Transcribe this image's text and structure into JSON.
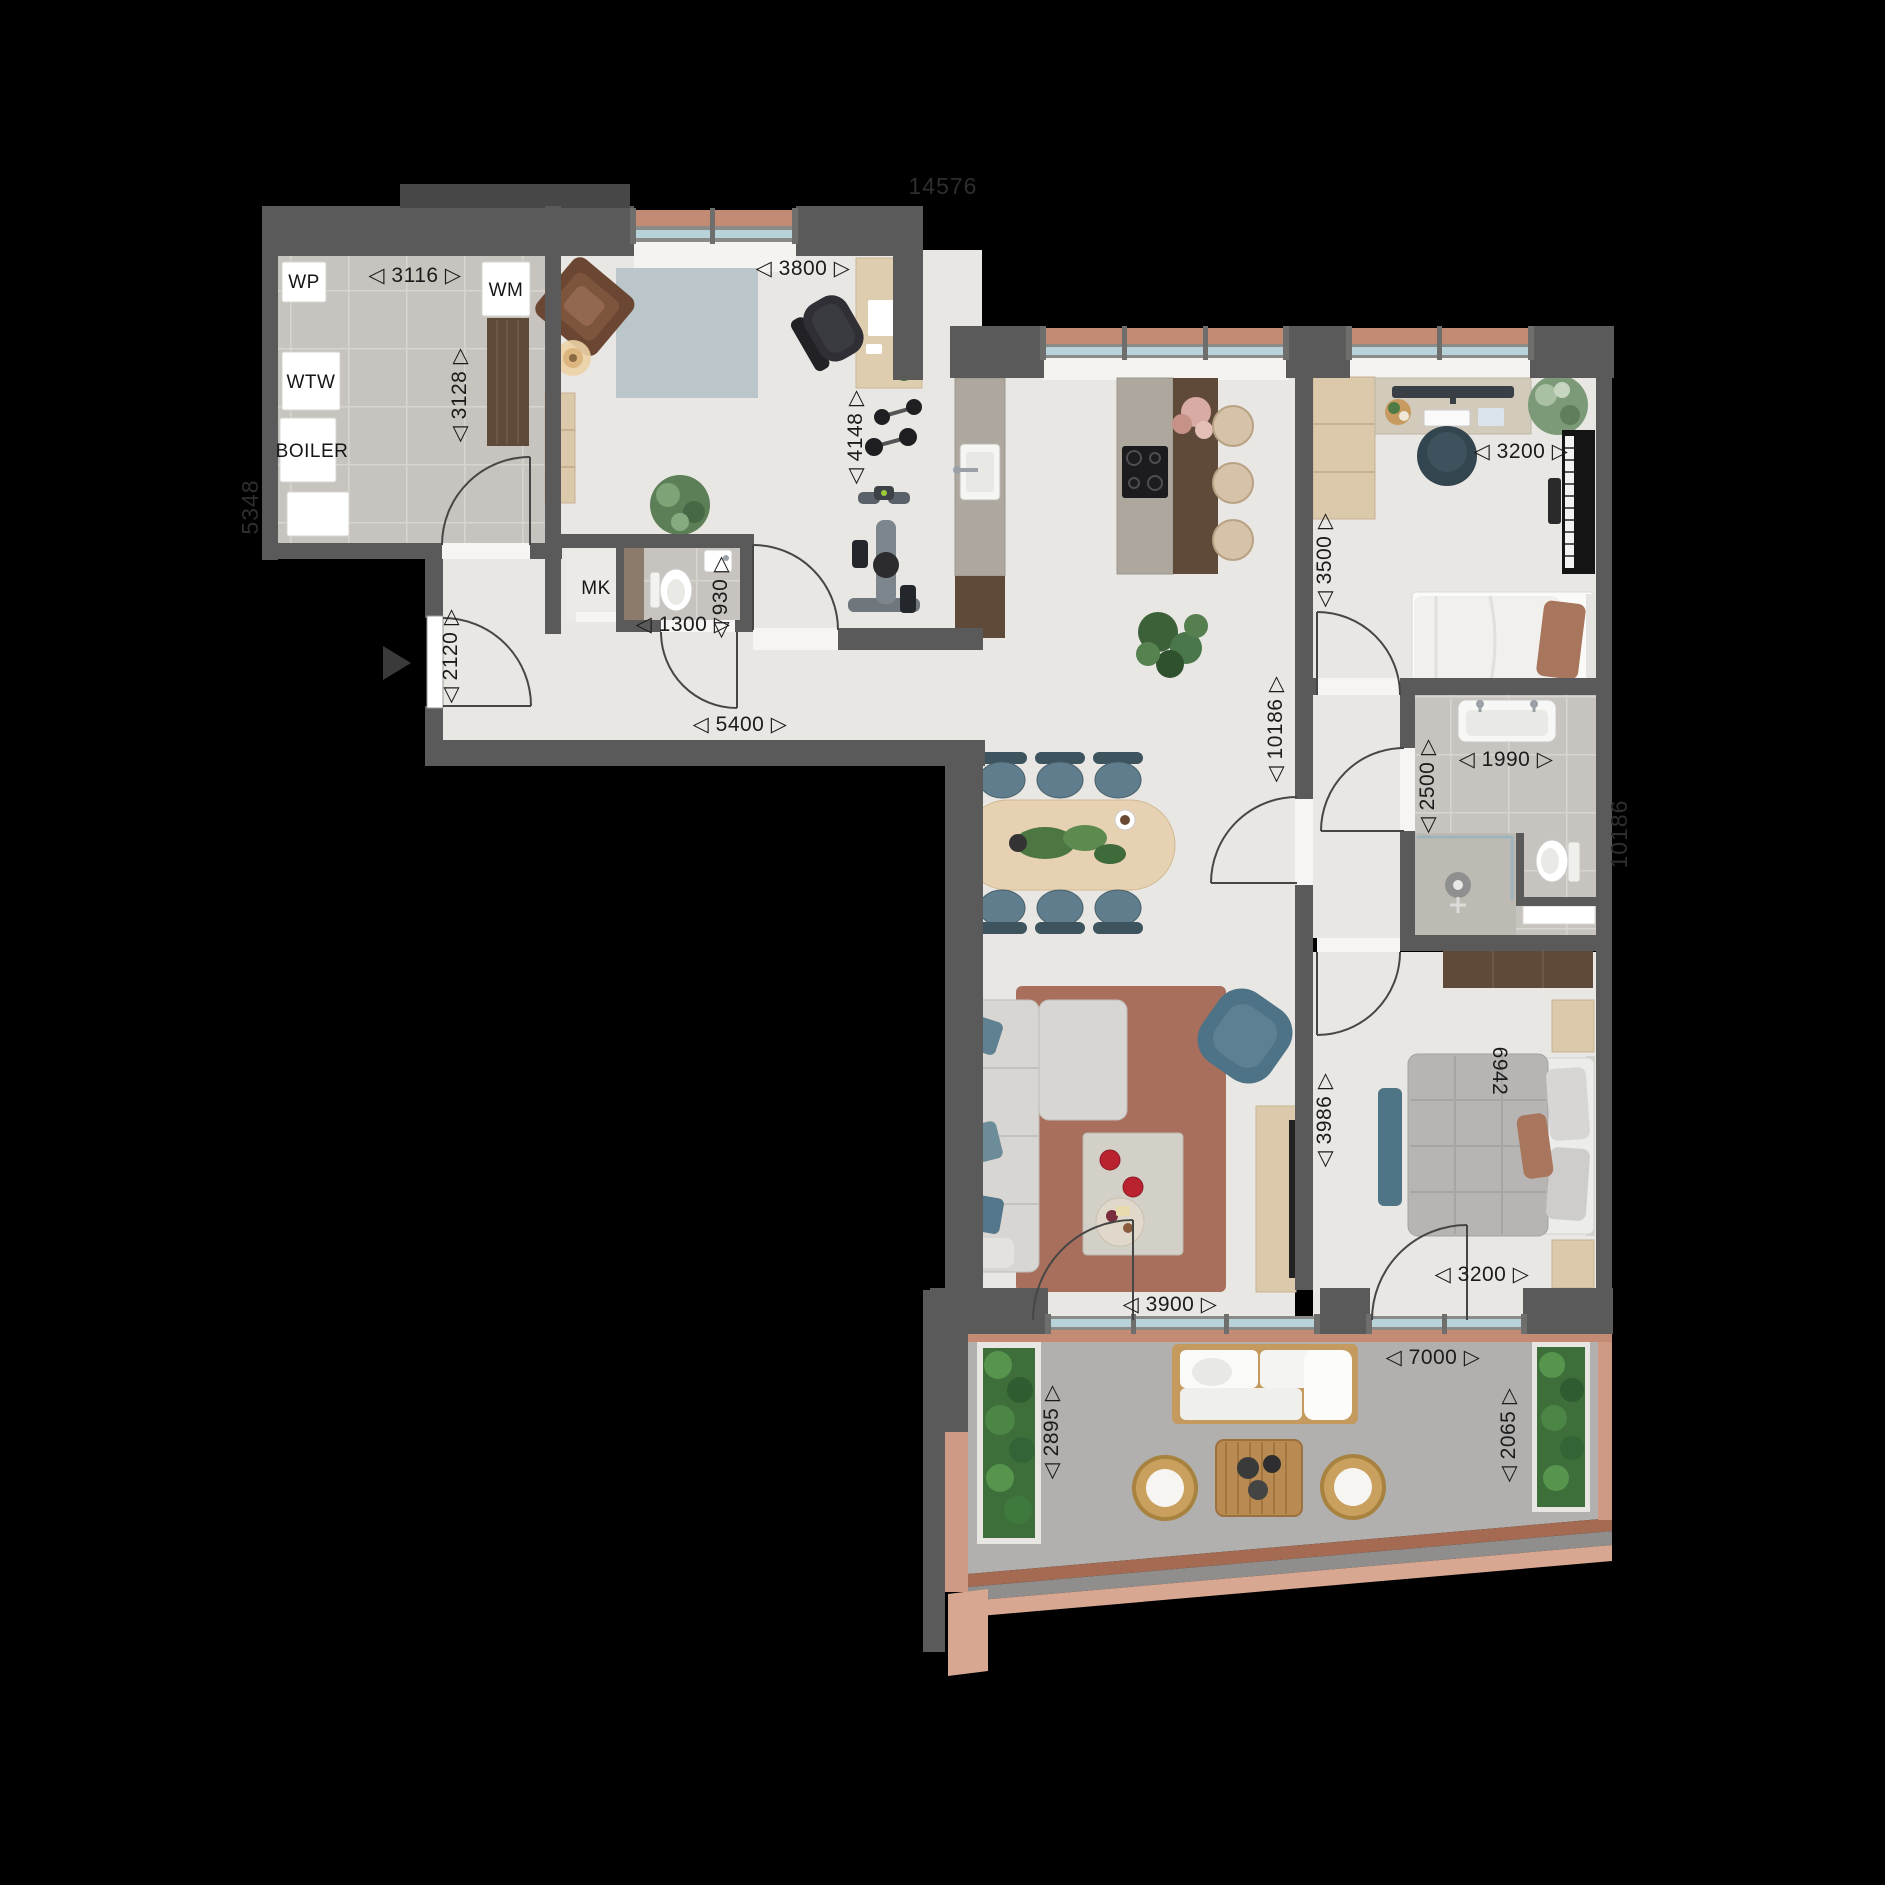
{
  "plan": {
    "appliances": {
      "wp": "WP",
      "wtw": "WTW",
      "boiler": "BOILER",
      "wm": "WM",
      "mk": "MK"
    },
    "dims": {
      "tech_width": "◁ 3116 ▷",
      "tech_depth": "◁ 3128 ▷",
      "study_width": "◁ 3800 ▷",
      "study_depth": "◁ 4148 ▷",
      "wc_width": "◁ 1300 ▷",
      "wc_depth": "◁ 930 ▷",
      "entry_depth": "◁ 2120 ▷",
      "hall_width": "◁ 5400 ▷",
      "bedroom2_width": "◁ 3200 ▷",
      "bedroom2_depth": "◁ 3500 ▷",
      "living_depth": "◁ 10186 ▷",
      "bath_width": "◁ 1990 ▷",
      "bath_depth": "◁ 2500 ▷",
      "bedroom1_depth": "◁ 3986 ▷",
      "bed_diag": "6942",
      "living_width": "◁ 3900 ▷",
      "bedroom1_width": "◁ 3200 ▷",
      "terrace_width": "◁ 7000 ▷",
      "terrace_depth_left": "◁ 2895 ▷",
      "terrace_depth_right": "◁ 2065 ▷"
    },
    "overall": {
      "top": "14576",
      "left": "5348",
      "right": "10186"
    },
    "colors": {
      "background": "#000000",
      "walls": "#5a5a5a",
      "floor": "#e9e7e3",
      "tile": "#c7c4bf",
      "terrace": "#b1b0ae",
      "window_glass": "#b7d3d9",
      "accent_terracotta": "#c38a74",
      "accent_blue": "#5f7d8c",
      "wood_dark": "#5d4936",
      "wood_light": "#d9c6a9",
      "rug_living": "#a8705c",
      "rug_study": "#bac6ca"
    }
  }
}
